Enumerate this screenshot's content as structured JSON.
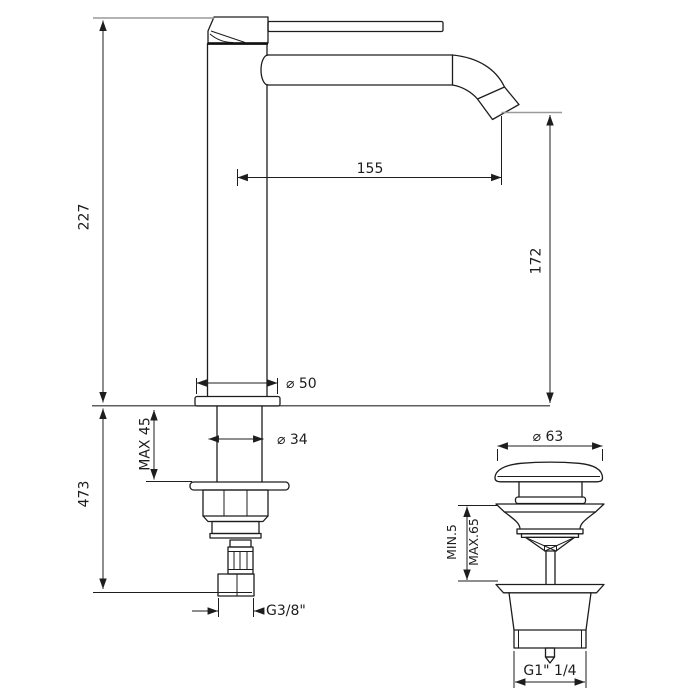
{
  "page": {
    "background": "#ffffff",
    "line_color": "#1d1d1d",
    "extension_line_color": "#9a9a9a"
  },
  "faucet_view": {
    "dimensions": {
      "deck_to_spout_top": "227",
      "overall_height": "473",
      "spout_reach": "155",
      "spout_outlet_height": "172",
      "base_diameter": "⌀ 50",
      "shank_diameter": "⌀ 34",
      "deck_max_thickness": "MAX 45",
      "supply_thread": "G3/8\""
    }
  },
  "waste_view": {
    "dimensions": {
      "cap_diameter": "⌀ 63",
      "deck_min_thickness": "MIN.5",
      "deck_max_thickness": "MAX.65",
      "outlet_thread": "G1\" 1/4"
    }
  }
}
